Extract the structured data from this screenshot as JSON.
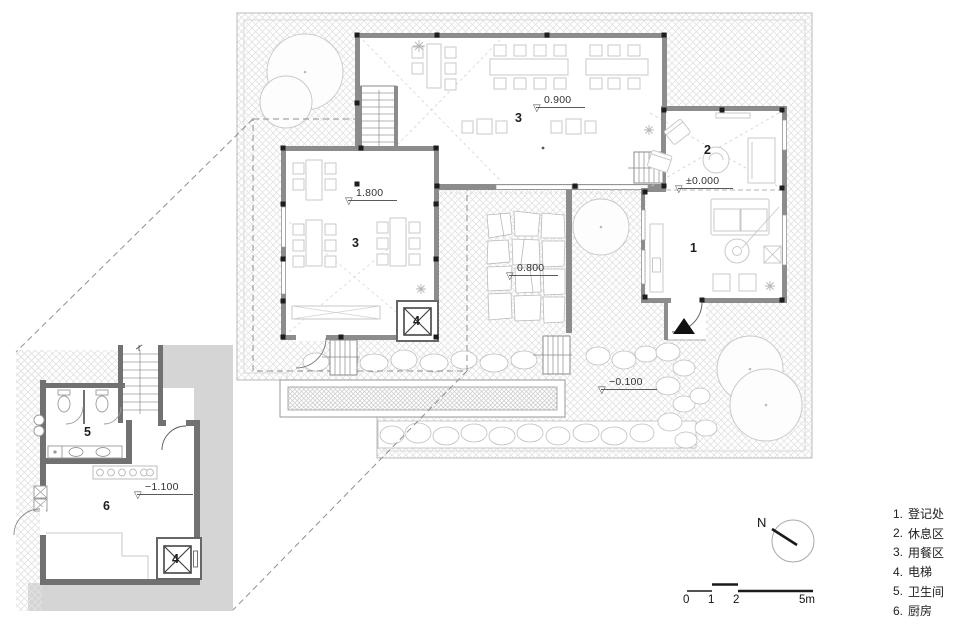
{
  "plan": {
    "rooms": {
      "registration": "1",
      "lounge": "2",
      "dining_top": "3",
      "dining_left": "3",
      "elevator_main": "4",
      "elevator_inset": "4",
      "toilet": "5",
      "kitchen": "6"
    },
    "levels": {
      "symbol": "▽",
      "top_dining": "0.900",
      "zero": "±0.000",
      "left_dining": "1.800",
      "courtyard": "0.800",
      "garden": "−0.100",
      "kitchen": "−1.100"
    }
  },
  "legend": {
    "items": [
      {
        "num": "1.",
        "label": "登记处"
      },
      {
        "num": "2.",
        "label": "休息区"
      },
      {
        "num": "3.",
        "label": "用餐区"
      },
      {
        "num": "4.",
        "label": "电梯"
      },
      {
        "num": "5.",
        "label": "卫生间"
      },
      {
        "num": "6.",
        "label": "厨房"
      }
    ]
  },
  "compass": {
    "north": "N"
  },
  "scalebar": {
    "ticks": [
      "0",
      "1",
      "2",
      "5m"
    ]
  },
  "colors": {
    "wall": "#8c8c8c",
    "wall_dark": "#5f5f5f",
    "inset_wall": "#717171",
    "inset_ground": "#d5d5d5",
    "hatch_line": "#dedede",
    "furniture": "#c9c9c9",
    "stone": "#bfbfbf",
    "tree": "#cccccc",
    "dash": "#949494",
    "column": "#1d1d1d",
    "entry_arrow": "#111111"
  }
}
